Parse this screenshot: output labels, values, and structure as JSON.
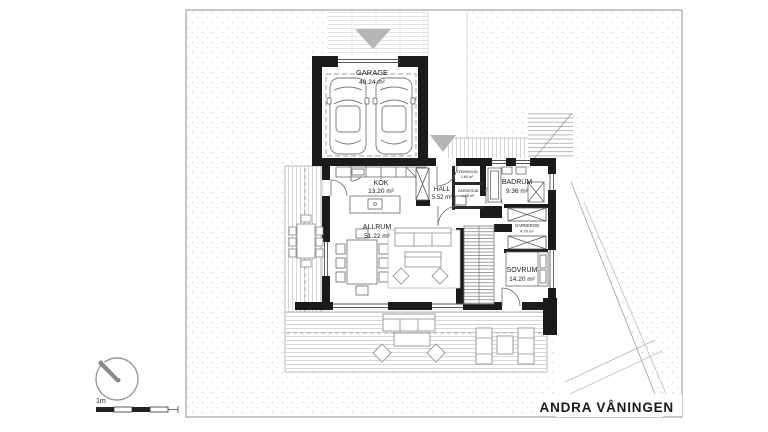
{
  "drawing": {
    "title": "ANDRA VÅNINGEN",
    "scale_label": "1m"
  },
  "rooms": [
    {
      "id": "garage",
      "name": "GARAGE",
      "area": "40.24 m²"
    },
    {
      "id": "kok",
      "name": "KÖK",
      "area": "13.20 m²"
    },
    {
      "id": "hall",
      "name": "HALL",
      "area": "5.52 m²"
    },
    {
      "id": "teknikrum",
      "name": "TEKNIKRUM",
      "area": "1.60 m²"
    },
    {
      "id": "garderob-hall",
      "name": "GARDEROB",
      "area": "1.28 m²"
    },
    {
      "id": "badrum",
      "name": "BADRUM",
      "area": "9.36 m²"
    },
    {
      "id": "garderob",
      "name": "GARDEROB",
      "area": "4.70 m²"
    },
    {
      "id": "sovrum",
      "name": "SOVRUM",
      "area": "14.20 m²"
    },
    {
      "id": "allrum",
      "name": "ALLRUM",
      "area": "51.22 m²"
    }
  ],
  "colors": {
    "wall": "#1b1b1b",
    "thin_line": "#666666",
    "hatch": "#cfcfcf",
    "marker": "#b5b5b5",
    "text": "#1a1a1a"
  }
}
